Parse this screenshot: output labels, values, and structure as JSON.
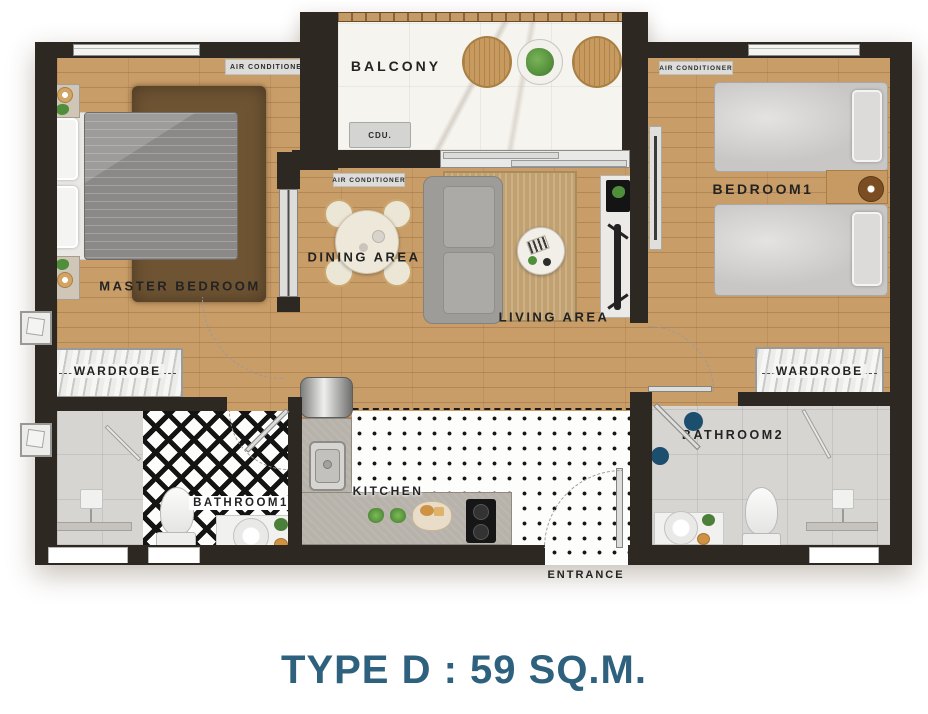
{
  "title": {
    "text": "TYPE D : 59 SQ.M."
  },
  "rooms": {
    "balcony": "BALCONY",
    "master_bedroom": "MASTER BEDROOM",
    "dining_area": "DINING AREA",
    "living_area": "LIVING AREA",
    "bedroom1": "BEDROOM1",
    "kitchen": "KITCHEN",
    "bathroom1": "BATHROOM1",
    "bathroom2": "BATHROOM2",
    "entrance": "ENTRANCE"
  },
  "storage": {
    "wardrobe_left": "WARDROBE",
    "wardrobe_right": "WARDROBE"
  },
  "equipment": {
    "ac_master": "AIR CONDITIONER",
    "ac_dining": "AIR CONDITIONER",
    "ac_bedroom1": "AIR CONDITIONER",
    "cdu": "CDU."
  },
  "colors": {
    "wall": "#2E2823",
    "wood_floor": "#C99D68",
    "marble_floor": "#F6F4EF",
    "gray_tile": "#D6D5D2",
    "counter": "#B7B3AB",
    "navy_accent": "#1C4E6E",
    "title_blue": "#2E617E",
    "diamond_dark": "#141414"
  }
}
